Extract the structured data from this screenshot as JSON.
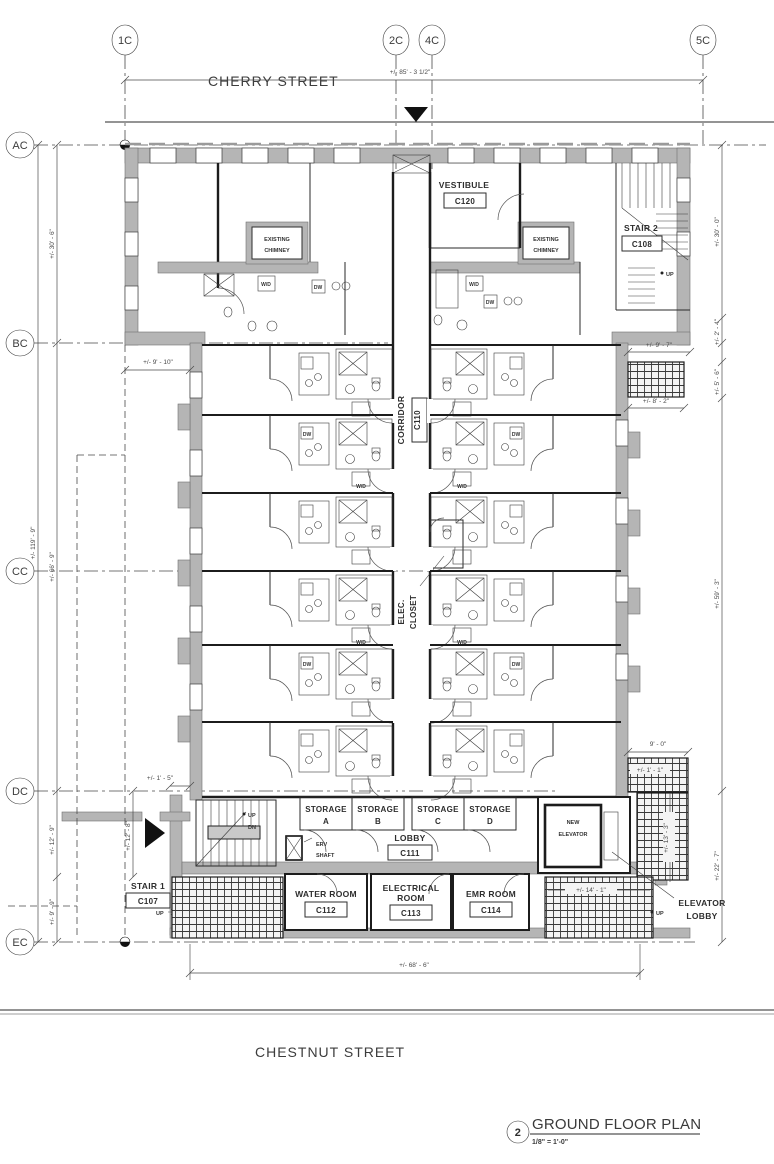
{
  "streets": {
    "top": "CHERRY STREET",
    "bottom": "CHESTNUT STREET"
  },
  "grid": {
    "cols": [
      {
        "label": "1C"
      },
      {
        "label": "2C"
      },
      {
        "label": "4C"
      },
      {
        "label": "5C"
      }
    ],
    "rows": [
      {
        "label": "AC"
      },
      {
        "label": "BC"
      },
      {
        "label": "CC"
      },
      {
        "label": "DC"
      },
      {
        "label": "EC"
      }
    ]
  },
  "rooms": {
    "vestibule": {
      "name": "VESTIBULE",
      "number": "C120"
    },
    "stair2": {
      "name": "STAIR 2",
      "number": "C108"
    },
    "corridor": {
      "name": "CORRIDOR",
      "number": "C110"
    },
    "elec_closet": {
      "line1": "ELEC.",
      "line2": "CLOSET"
    },
    "lobby": {
      "name": "LOBBY",
      "number": "C111"
    },
    "stair1": {
      "name": "STAIR 1",
      "number": "C107"
    },
    "water_room": {
      "name": "WATER ROOM",
      "number": "C112"
    },
    "electrical_room": {
      "line1": "ELECTRICAL",
      "line2": "ROOM",
      "number": "C113"
    },
    "emr_room": {
      "name": "EMR ROOM",
      "number": "C114"
    },
    "new_elevator": {
      "line1": "NEW",
      "line2": "ELEVATOR"
    },
    "elevator_lobby": {
      "line1": "ELEVATOR",
      "line2": "LOBBY"
    },
    "storage": {
      "name": "STORAGE",
      "units": [
        "A",
        "B",
        "C",
        "D"
      ]
    },
    "chimney": {
      "line1": "EXISTING",
      "line2": "CHIMNEY"
    },
    "erv_shaft": {
      "line1": "ERV",
      "line2": "SHAFT"
    }
  },
  "fixtures": {
    "wd": "W/D",
    "dw": "DW",
    "up": "UP",
    "dn": "DN"
  },
  "dimensions": {
    "top_width": "+/- 85' - 3 1/2\"",
    "left_total": "+/- 119' - 9\"",
    "left_upper": "+/- 30' - 6\"",
    "left_mid": "+/- 66' - 9\"",
    "left_lower1": "+/- 12' - 9\"",
    "left_lower2": "+/- 9' - 9\"",
    "left_lower_inner": "+/- 12' - 8\"",
    "west_offset": "+/- 9' - 10\"",
    "entry_offset": "+/- 1' - 5\"",
    "right_upper": "+/- 30' - 0\"",
    "right_step": "+/- 2' - 4\"",
    "right_offset": "+/- 9' - 7\"",
    "areaway_height": "+/- 5' - 6\"",
    "areaway_width": "+/- 8' - 2\"",
    "right_mid": "+/- 59' - 3\"",
    "right_lower": "+/- 22' - 7\"",
    "elev_area_width": "9' - 0\"",
    "elev_area_step": "+/- 1' - 1\"",
    "elev_lobby_height": "+/- 13' - 3\"",
    "vault_width": "+/- 14' - 1\"",
    "bottom_width": "+/- 68' - 6\""
  },
  "title": {
    "number": "2",
    "text": "GROUND FLOOR PLAN",
    "scale": "1/8\" = 1'-0\""
  }
}
